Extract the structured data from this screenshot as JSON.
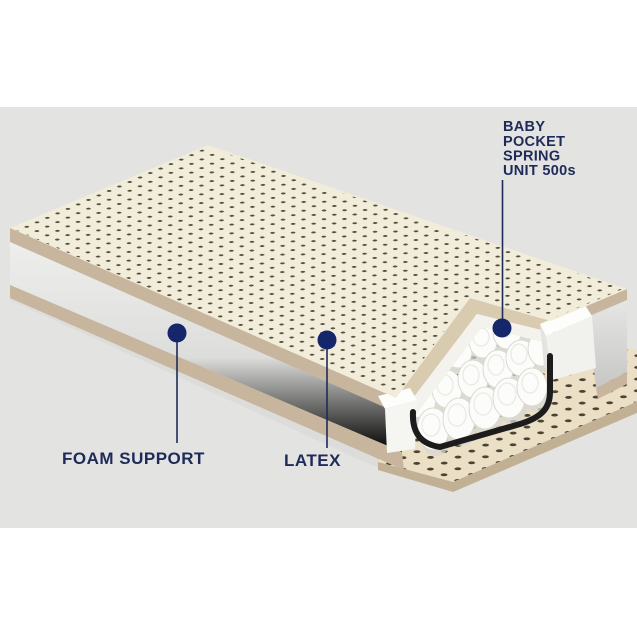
{
  "page": {
    "background": "#ffffff",
    "band_background": "#e3e3e1"
  },
  "diagram": {
    "labels": {
      "spring_unit": {
        "lines": [
          "BABY",
          "POCKET",
          "SPRING",
          "UNIT 500s"
        ]
      },
      "foam_support": {
        "text": "FOAM SUPPORT"
      },
      "latex": {
        "text": "LATEX"
      }
    },
    "colors": {
      "label_text": "#1e2b58",
      "leader_line": "#1e2b58",
      "marker_dot": "#15266b",
      "latex_cream": "#f2ecda",
      "perforation": "#55503c",
      "tan_edge": "#c7b69d",
      "tan_edge_dark": "#c2b095",
      "cut_face_tan": "#d9cbb0",
      "foam_side_light": "#ebebe9",
      "foam_side_dark": "#cfcfcb",
      "foam_block_white": "#f8f8f6",
      "spring_white": "#fcfcfa",
      "spring_shadow": "#d7d7d2",
      "wire": "#1c1c1c",
      "base_ledge": "#ebdfc6"
    }
  }
}
